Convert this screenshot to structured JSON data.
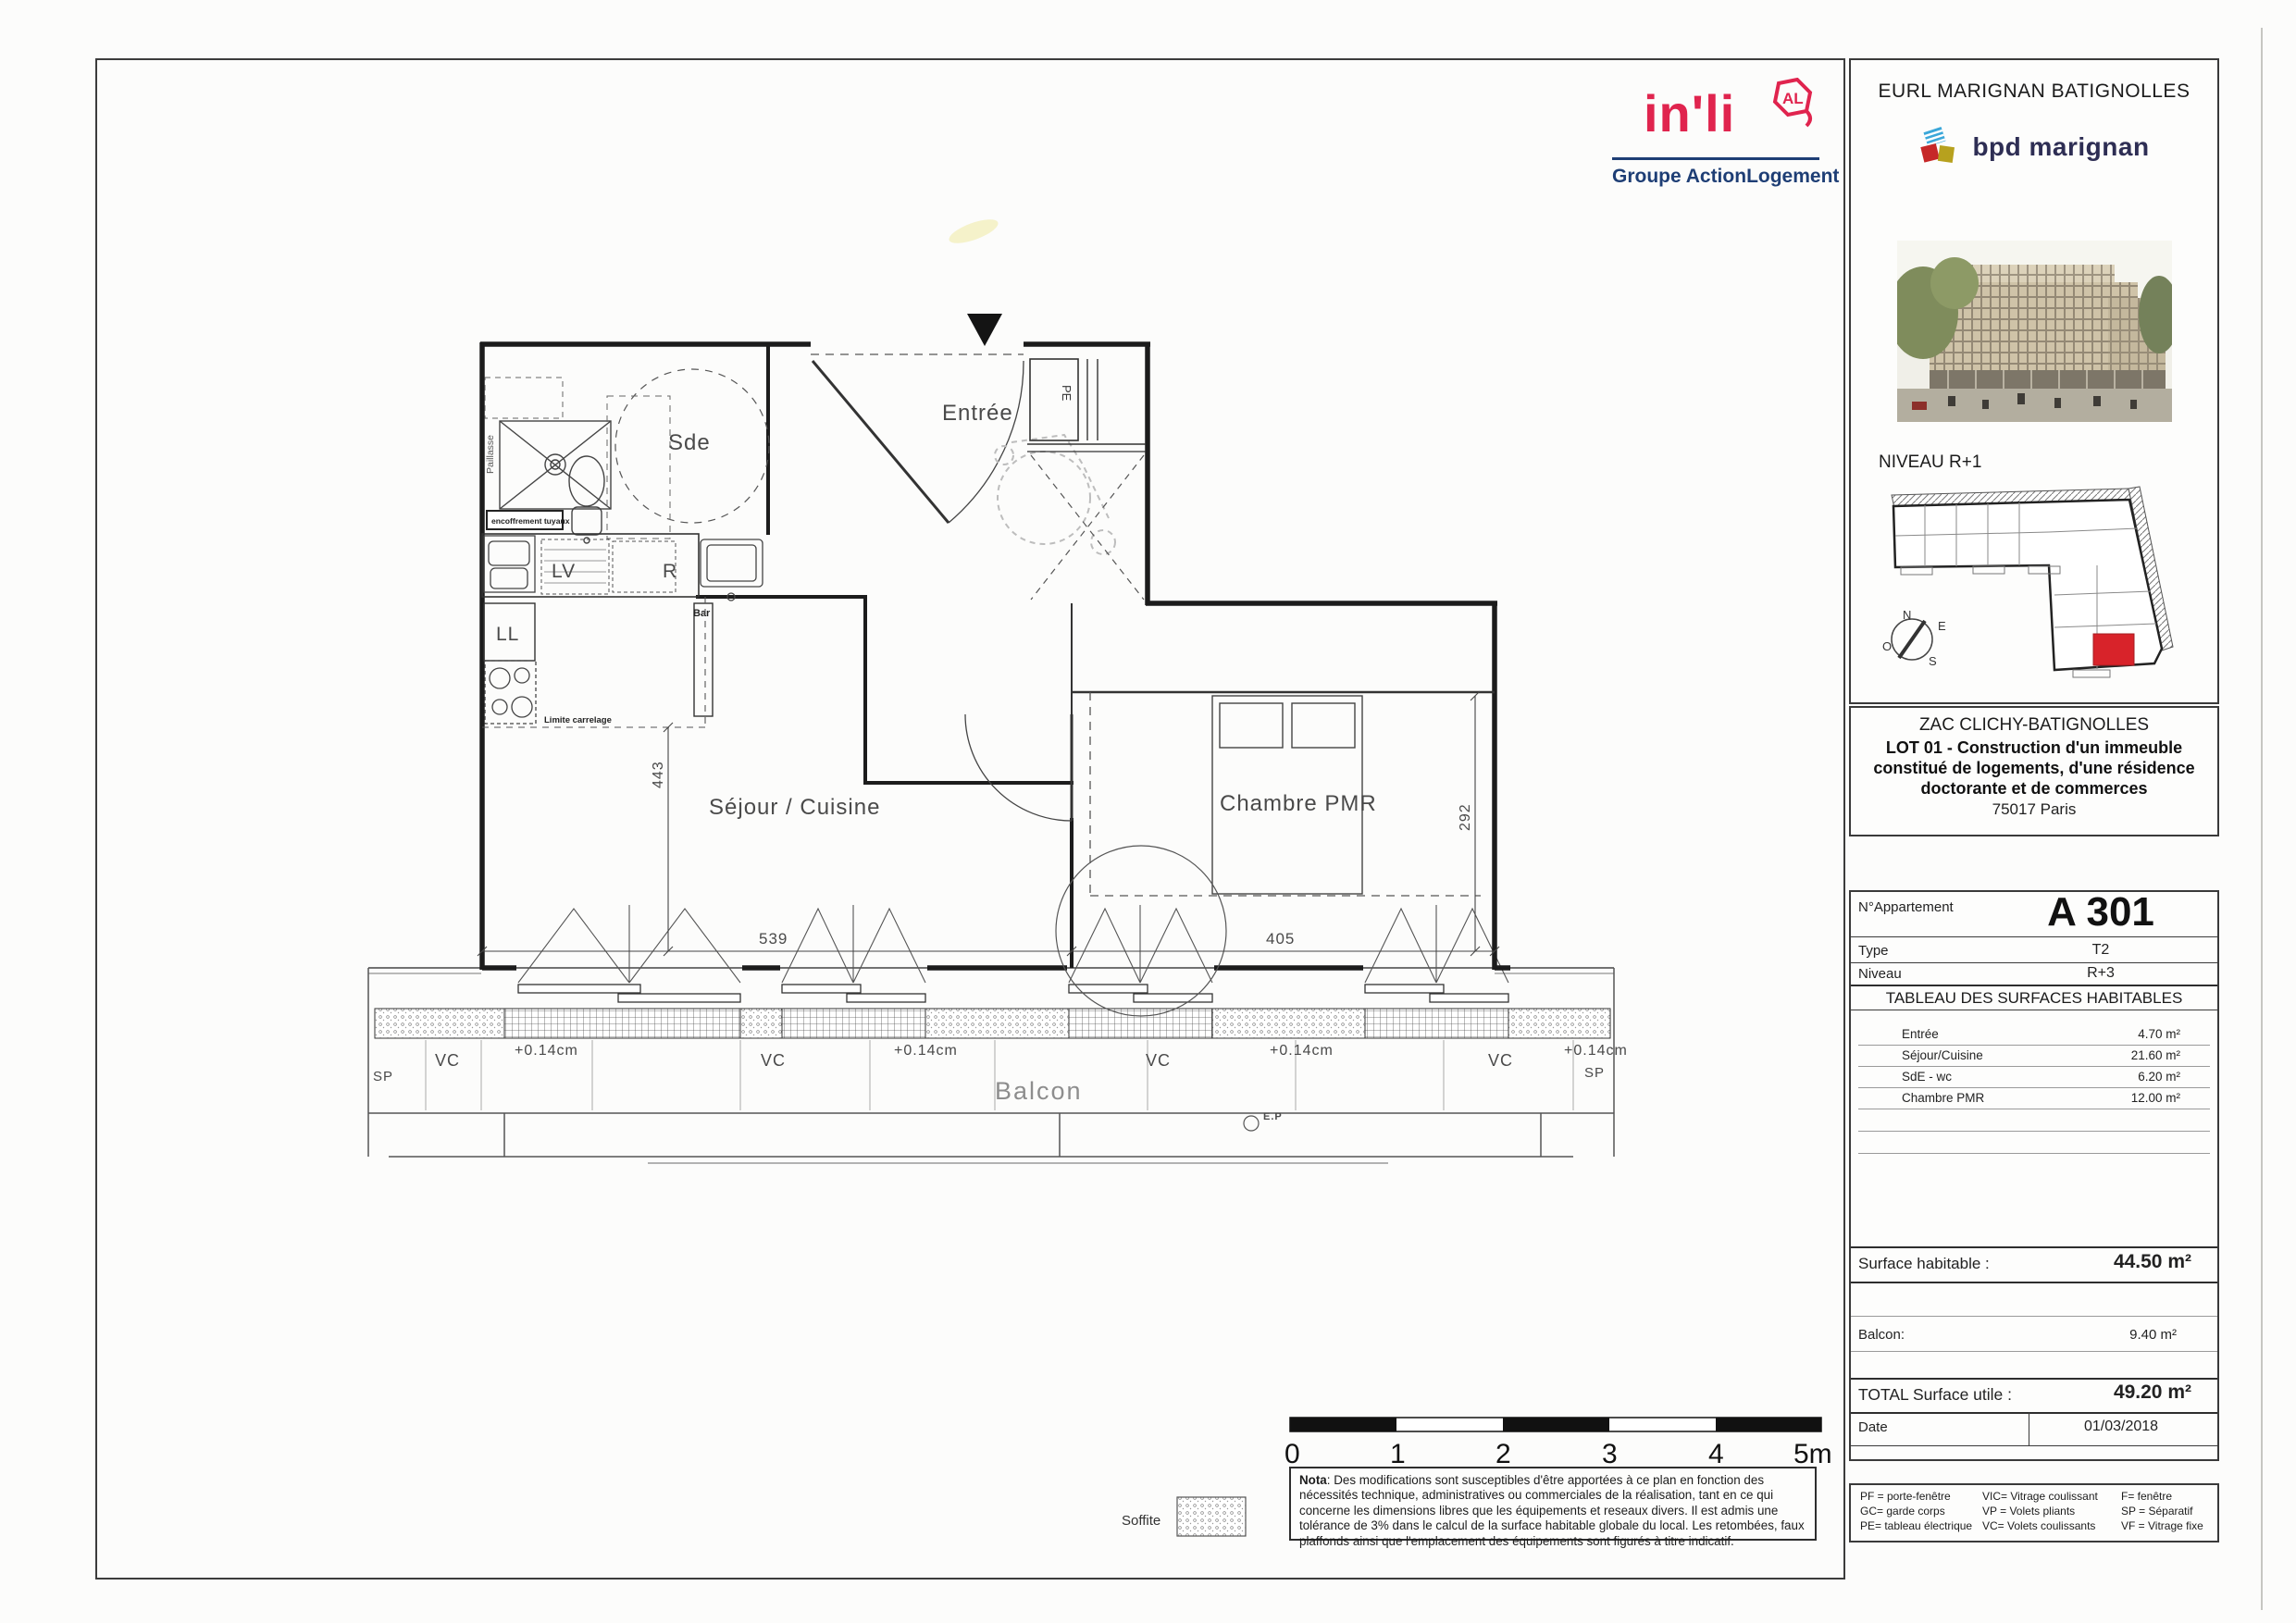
{
  "header": {
    "company": "EURL MARIGNAN BATIGNOLLES",
    "brand": "bpd marignan",
    "level_label": "NIVEAU R+1",
    "compass": {
      "n": "N",
      "e": "E",
      "o": "O",
      "s": "S"
    },
    "project": {
      "zac": "ZAC CLICHY-BATIGNOLLES",
      "lot": "LOT 01 - Construction d'un immeuble constitué de logements, d'une résidence doctorante et de commerces",
      "city": "75017 Paris"
    }
  },
  "inli": {
    "word": "in'li",
    "badge": "AL",
    "group_normal": "Groupe Action",
    "group_bold": "Logement"
  },
  "apartment": {
    "number_label": "N°Appartement",
    "number": "A 301",
    "type_label": "Type",
    "type": "T2",
    "level_label": "Niveau",
    "level": "R+3",
    "table_title": "TABLEAU DES SURFACES HABITABLES",
    "rooms": [
      {
        "label": "Entrée",
        "area": "4.70 m²"
      },
      {
        "label": "Séjour/Cuisine",
        "area": "21.60 m²"
      },
      {
        "label": "SdE - wc",
        "area": "6.20 m²"
      },
      {
        "label": "Chambre PMR",
        "area": "12.00 m²"
      }
    ],
    "surface_label": "Surface habitable :",
    "surface": "44.50 m²",
    "balcony_label": "Balcon:",
    "balcony": "9.40 m²",
    "total_label": "TOTAL Surface utile :",
    "total": "49.20 m²",
    "date_label": "Date",
    "date": "01/03/2018"
  },
  "legend": {
    "col1": [
      "PF = porte-fenêtre",
      "GC= garde corps",
      "PE= tableau électrique"
    ],
    "col2": [
      "VIC= Vitrage coulissant",
      "VP = Volets pliants",
      "VC= Volets coulissants"
    ],
    "col3": [
      "F= fenêtre",
      "SP = Séparatif",
      "VF = Vitrage fixe"
    ]
  },
  "nota": {
    "title": "Nota",
    "body": ": Des modifications sont susceptibles d'être apportées à ce plan en fonction des nécessités technique, administratives ou commerciales de la réalisation, tant en ce qui concerne les dimensions libres que les équipements et reseaux divers. Il est admis une tolérance de 3% dans le calcul de la surface habitable globale du local. Les retombées, faux plaffonds ainsi que l'emplacement des équipements sont figurés à titre indicatif."
  },
  "scalebar": {
    "ticks": [
      "0",
      "1",
      "2",
      "3",
      "4",
      "5m"
    ]
  },
  "plan": {
    "rooms": {
      "sde": "Sde",
      "entree": "Entrée",
      "sejour": "Séjour / Cuisine",
      "chambre": "Chambre PMR",
      "balcon": "Balcon"
    },
    "labels": {
      "paillasse": "Paillasse",
      "encoffrement": "encoffrement tuyaux",
      "lv": "LV",
      "r": "R",
      "ll": "LL",
      "bar": "Bar",
      "limite": "Limite carrelage",
      "pe": "PE",
      "ep": "E.P",
      "vc": "VC",
      "sp": "SP",
      "offset": "+0.14cm",
      "soffite": "Soffite"
    },
    "dims": {
      "sejour_w": "539",
      "sejour_h": "443",
      "chambre_w": "405",
      "chambre_h": "292"
    }
  },
  "colors": {
    "inli_pink": "#e0244e",
    "inli_navy": "#1e3e75",
    "brand_navy": "#2e2e54",
    "brand_blue": "#3ba7d9",
    "brand_red": "#c62828",
    "brand_gold": "#b7a11e",
    "keyplan_red": "#d8232a"
  }
}
